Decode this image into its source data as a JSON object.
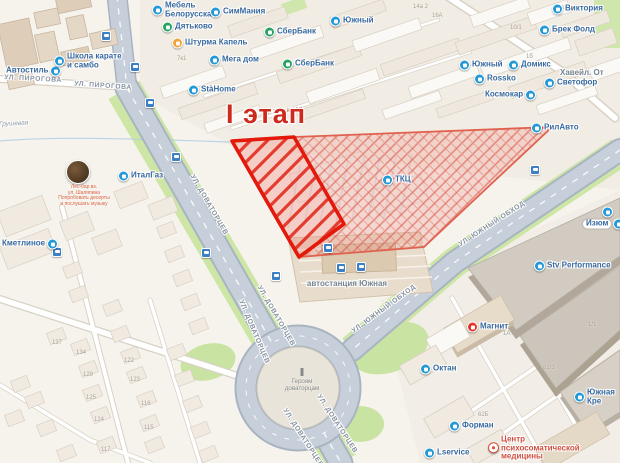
{
  "map": {
    "stage_label": "I этап",
    "river_labels": [
      {
        "t": "р. Грушевая",
        "x": 10,
        "y": 124,
        "r": -3,
        "cls": "muted"
      },
      {
        "t": "р. Грушевая",
        "x": 284,
        "y": 111,
        "r": -7,
        "cls": "red"
      }
    ],
    "street_labels": [
      {
        "t": "ул. Пирогова",
        "x": 33,
        "y": 79,
        "r": 3
      },
      {
        "t": "ул. Пирогова",
        "x": 103,
        "y": 86,
        "r": 4
      },
      {
        "t": "ул. Доваторцев",
        "x": 209,
        "y": 205,
        "r": 60
      },
      {
        "t": "ул. Доваторцев",
        "x": 276,
        "y": 316,
        "r": 60
      },
      {
        "t": "ул. Доваторцев",
        "x": 254,
        "y": 332,
        "r": 67
      },
      {
        "t": "ул. Доваторцев",
        "x": 337,
        "y": 424,
        "r": 57
      },
      {
        "t": "ул. Доваторцев",
        "x": 303,
        "y": 438,
        "r": 57
      },
      {
        "t": "ул. Южный обход",
        "x": 492,
        "y": 224,
        "r": -33
      },
      {
        "t": "ул. Южный обход",
        "x": 384,
        "y": 309,
        "r": -36
      }
    ],
    "pois": [
      {
        "lines": [
          "Мебель",
          "Белорусская"
        ],
        "x": 152,
        "y": 10,
        "icon": "blue"
      },
      {
        "t": "СимМания",
        "x": 210,
        "y": 12,
        "icon": "blue"
      },
      {
        "t": "Дятьково",
        "x": 162,
        "y": 27,
        "icon": "green"
      },
      {
        "t": "Штурма Капель",
        "x": 172,
        "y": 43,
        "icon": "orange"
      },
      {
        "t": "СберБанк",
        "x": 264,
        "y": 32,
        "icon": "green"
      },
      {
        "t": "СберБанк",
        "x": 282,
        "y": 64,
        "icon": "green"
      },
      {
        "t": "Мега дом",
        "x": 209,
        "y": 60,
        "icon": "blue"
      },
      {
        "t": "StàHome",
        "x": 188,
        "y": 90,
        "icon": "blue"
      },
      {
        "t": "Автостиль",
        "x": 6,
        "y": 71,
        "icon": "blue",
        "side": "right"
      },
      {
        "lines": [
          "Школа карате",
          "и самбо"
        ],
        "x": 54,
        "y": 61,
        "icon": "blue"
      },
      {
        "t": "Южный",
        "x": 330,
        "y": 21,
        "icon": "blue"
      },
      {
        "t": "Виктория",
        "x": 552,
        "y": 9,
        "icon": "blue"
      },
      {
        "t": "Брек Фолд",
        "x": 539,
        "y": 30,
        "icon": "blue"
      },
      {
        "t": "Южный",
        "x": 459,
        "y": 65,
        "icon": "blue"
      },
      {
        "t": "Домикс",
        "x": 508,
        "y": 65,
        "icon": "blue"
      },
      {
        "t": "Rossko",
        "x": 474,
        "y": 79,
        "icon": "blue"
      },
      {
        "t": "Светофор",
        "x": 544,
        "y": 83,
        "icon": "blue"
      },
      {
        "t": "Космокар",
        "x": 485,
        "y": 95,
        "icon": "blue",
        "side": "right"
      },
      {
        "t": "Хавейл. От",
        "x": 560,
        "y": 73,
        "icon": "none",
        "cls": "gray"
      },
      {
        "t": "РилАвто",
        "x": 531,
        "y": 128,
        "icon": "blue"
      },
      {
        "t": "ИталГаз",
        "x": 118,
        "y": 176,
        "icon": "blue"
      },
      {
        "t": "Кметлиное",
        "x": 2,
        "y": 244,
        "icon": "blue",
        "side": "right"
      },
      {
        "t": "ТКЦ",
        "x": 382,
        "y": 180,
        "icon": "blue"
      },
      {
        "t": "автостанция Южная",
        "x": 347,
        "y": 284,
        "icon": "none",
        "cls": "gray",
        "center": true
      },
      {
        "t": "Магнит",
        "x": 467,
        "y": 327,
        "icon": "magnit"
      },
      {
        "t": "Октан",
        "x": 420,
        "y": 369,
        "icon": "blue"
      },
      {
        "t": "Форман",
        "x": 449,
        "y": 426,
        "icon": "blue"
      },
      {
        "lines": [
          "Центр",
          "психосоматической",
          "медицины"
        ],
        "x": 488,
        "y": 448,
        "icon": "med",
        "cls": "red"
      },
      {
        "t": "Stv Performance",
        "x": 534,
        "y": 266,
        "icon": "blue"
      },
      {
        "t": "Изюм",
        "x": 583,
        "y": 224,
        "icon": "blue",
        "side": "right",
        "pill": true
      },
      {
        "t": "Южная Кре",
        "x": 574,
        "y": 397,
        "icon": "blue"
      },
      {
        "t": "Lservice",
        "x": 424,
        "y": 453,
        "icon": "blue"
      },
      {
        "t": "",
        "x": 602,
        "y": 212,
        "icon": "blue"
      }
    ],
    "transit_stops": [
      [
        106,
        36
      ],
      [
        135,
        67
      ],
      [
        150,
        103
      ],
      [
        176,
        157
      ],
      [
        57,
        252
      ],
      [
        206,
        253
      ],
      [
        535,
        170
      ],
      [
        328,
        248
      ],
      [
        341,
        268
      ],
      [
        361,
        267
      ],
      [
        276,
        276
      ]
    ],
    "building_numbers": [
      [
        "14а 2",
        413,
        4
      ],
      [
        "16а 2",
        554,
        5
      ],
      [
        "16А",
        432,
        13
      ],
      [
        "10/1",
        510,
        25
      ],
      [
        "1б",
        526,
        54
      ],
      [
        "7к1",
        177,
        56
      ],
      [
        "137",
        52,
        340
      ],
      [
        "134",
        76,
        350
      ],
      [
        "129",
        83,
        372
      ],
      [
        "125",
        86,
        395
      ],
      [
        "124",
        94,
        417
      ],
      [
        "117",
        101,
        447
      ],
      [
        "122",
        124,
        358
      ],
      [
        "123",
        130,
        377
      ],
      [
        "116",
        141,
        401
      ],
      [
        "115",
        144,
        425
      ],
      [
        "1/1",
        588,
        322
      ],
      [
        "82/3",
        543,
        365
      ],
      [
        "62Б",
        478,
        412
      ],
      [
        "1А",
        503,
        331
      ]
    ],
    "photo_poi": {
      "x": 78,
      "y": 172,
      "caption": [
        "Лес-бар вз.",
        "ул. Шаляпина",
        "Попробовать десерты",
        "и послушать музыку"
      ]
    },
    "monument": {
      "x": 302,
      "y": 380,
      "lines": [
        "Героям",
        "доваторцам"
      ]
    }
  }
}
